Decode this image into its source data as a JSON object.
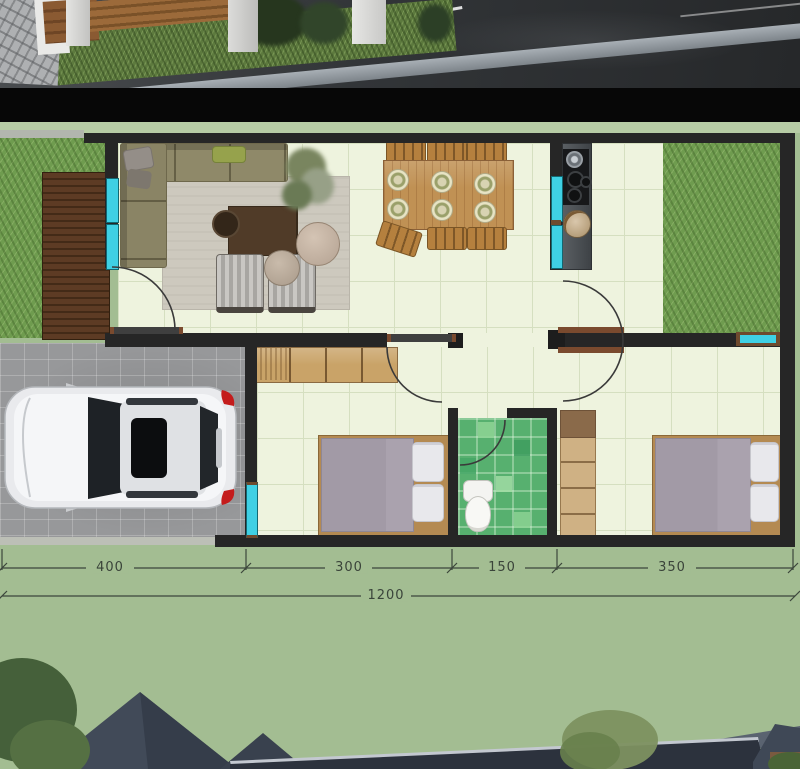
{
  "sections": [
    "street-photo-render",
    "floor-plan",
    "exterior-photo-render"
  ],
  "floor_plan": {
    "dimensions": {
      "segments": [
        {
          "label": "400"
        },
        {
          "label": "300"
        },
        {
          "label": "150"
        },
        {
          "label": "350"
        }
      ],
      "total": {
        "label": "1200"
      }
    },
    "features": [
      "wood-deck",
      "front-lawn",
      "living-room-sofa",
      "rug",
      "coffee-table",
      "armchairs",
      "potted-plant",
      "dining-table-six-plates",
      "kitchen-counter-cooktop",
      "backyard-lawn",
      "carport-with-car",
      "bedroom-1-bed",
      "bedroom-1-wardrobe",
      "bathroom-toilet",
      "bedroom-2-bed",
      "bedroom-2-wardrobe"
    ],
    "colors": {
      "plan_background": "#a3bd92",
      "wall": "#262626",
      "window_glass": "#3fd0e4",
      "floor": "#eef3de",
      "floor_grid": "#d5dfc0",
      "lawn": "#6f9c4f",
      "deck": "#5d3b24",
      "bathroom_tile": "#57b06f",
      "wood_furniture": "#c09154",
      "kitchen_counter": "#4a4f53",
      "mattress": "#a79fab",
      "dimension_text": "#3a443a"
    }
  }
}
